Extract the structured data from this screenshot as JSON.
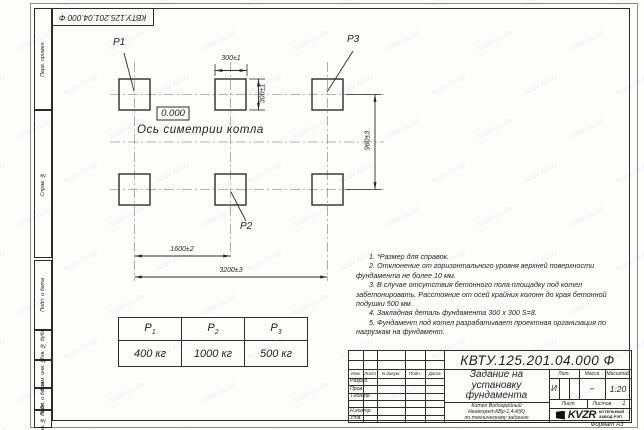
{
  "page": {
    "format_label": "Формат А3",
    "watermark": "kotel-kv.kz"
  },
  "corner_stamp": {
    "doc_number": "КВТУ.125.201.04.000  Ф"
  },
  "margin_labels": [
    "Перв. примен.",
    "Справ. №",
    "Подп. и дата",
    "Инв. № дубл.",
    "Взам. инв. №",
    "Подп. и дата",
    "Инв. № подл."
  ],
  "drawing": {
    "pad_labels": {
      "p1": "P1",
      "p2": "P2",
      "p3": "P3"
    },
    "elevation": "0.000",
    "axis_label": "Ось симетрии котла",
    "dimensions": {
      "pad_width": "300±1",
      "pad_height": "300±1",
      "row_spacing": "960±3",
      "col_spacing": "1600±2",
      "total_span": "3200±3"
    }
  },
  "notes": [
    "1. *Размер для справок.",
    "2. Отклонение от горизонтального уровня верхней поверхности фундамента не более 10 мм.",
    "3. В случае отсутствия бетонного пола площадку под котел забетонировать. Расстояние от осей крайних колонн до края бетонной подушки 500 мм.",
    "4. Закладная деталь фундамента  300 x 300  S=8.",
    "5. Фундамент под котел разрабатывает проектная организация по нагрузкам на фундамент."
  ],
  "load_table": {
    "headers": [
      {
        "base": "P",
        "sub": "1"
      },
      {
        "base": "P",
        "sub": "2"
      },
      {
        "base": "P",
        "sub": "3"
      }
    ],
    "values": [
      "400 кг",
      "1000 кг",
      "500 кг"
    ]
  },
  "title_block": {
    "doc_number": "КВТУ.125.201.04.000  Ф",
    "title_lines": [
      "Задание на",
      "установку",
      "фундамента"
    ],
    "subtitle_lines": [
      "Котел Водогрейный",
      "Heatexpert-КВр-1,4-К(К)",
      "по техническому заданию"
    ],
    "columns": [
      "Изм.",
      "Лист",
      "N докум.",
      "Подп.",
      "Дата"
    ],
    "rows": [
      "Разраб.",
      "Пров.",
      "Т.контр.",
      "",
      "Н.контр.",
      "Утв."
    ],
    "lit_header": "Лит.",
    "lit_value": "И",
    "mass_header": "Масса",
    "mass_value": "–",
    "scale_header": "Масштаб",
    "scale_value": "1:20",
    "sheet_header": "Лист",
    "sheets_header": "Листов",
    "sheets_value": "1",
    "logo_text": "KVZR",
    "logo_caption_lines": [
      "КОТЕЛЬНЫЙ",
      "ЗАВОД РЭП"
    ]
  }
}
